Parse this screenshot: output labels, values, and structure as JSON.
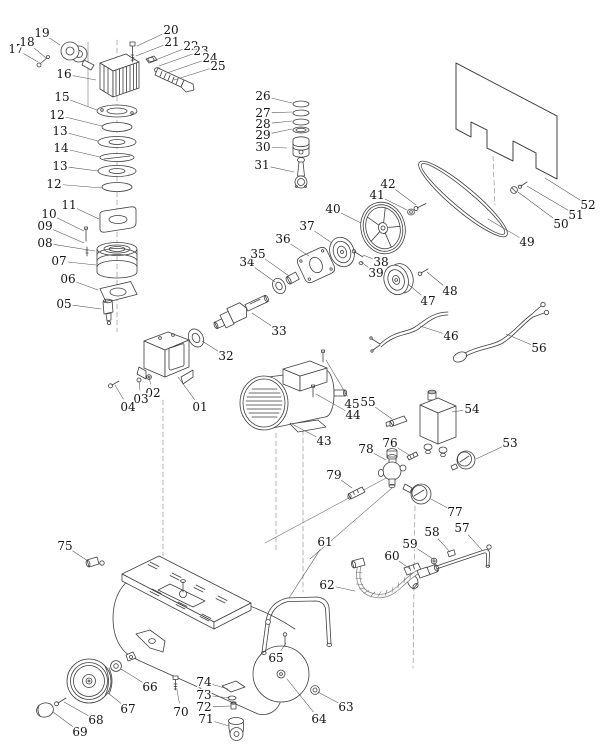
{
  "figure": {
    "kind": "exploded-parts-diagram",
    "subject": "air compressor",
    "background": "#ffffff",
    "line_color": "#3f3f3f",
    "label_color": "#151515"
  },
  "parts": [
    {
      "n": "01",
      "l": [
        200,
        407
      ],
      "t": [
        178,
        377
      ]
    },
    {
      "n": "02",
      "l": [
        153,
        393
      ],
      "t": [
        149,
        378
      ]
    },
    {
      "n": "03",
      "l": [
        141,
        399
      ],
      "t": [
        139,
        381
      ]
    },
    {
      "n": "04",
      "l": [
        128,
        407
      ],
      "t": [
        115,
        385
      ]
    },
    {
      "n": "05",
      "l": [
        64,
        304
      ],
      "t": [
        101,
        309
      ]
    },
    {
      "n": "06",
      "l": [
        68,
        279
      ],
      "t": [
        98,
        290
      ]
    },
    {
      "n": "07",
      "l": [
        59,
        261
      ],
      "t": [
        96,
        265
      ]
    },
    {
      "n": "08",
      "l": [
        45,
        243
      ],
      "t": [
        95,
        251
      ]
    },
    {
      "n": "09",
      "l": [
        45,
        226
      ],
      "t": [
        84,
        243
      ]
    },
    {
      "n": "10",
      "l": [
        49,
        214
      ],
      "t": [
        84,
        231
      ]
    },
    {
      "n": "11",
      "l": [
        69,
        205
      ],
      "t": [
        99,
        219
      ]
    },
    {
      "n": "12",
      "l": [
        54,
        184
      ],
      "t": [
        102,
        188
      ]
    },
    {
      "n": "13",
      "l": [
        60,
        166
      ],
      "t": [
        98,
        171
      ]
    },
    {
      "n": "14",
      "l": [
        61,
        148
      ],
      "t": [
        100,
        157
      ]
    },
    {
      "n": "13",
      "l": [
        60,
        131
      ],
      "t": [
        98,
        141
      ]
    },
    {
      "n": "12",
      "l": [
        57,
        115
      ],
      "t": [
        102,
        126
      ]
    },
    {
      "n": "15",
      "l": [
        62,
        97
      ],
      "t": [
        97,
        110
      ]
    },
    {
      "n": "16",
      "l": [
        64,
        74
      ],
      "t": [
        96,
        80
      ]
    },
    {
      "n": "17",
      "l": [
        16,
        49
      ],
      "t": [
        38,
        62
      ]
    },
    {
      "n": "18",
      "l": [
        27,
        42
      ],
      "t": [
        46,
        58
      ]
    },
    {
      "n": "19",
      "l": [
        42,
        33
      ],
      "t": [
        60,
        45
      ]
    },
    {
      "n": "20",
      "l": [
        171,
        30
      ],
      "t": [
        137,
        46
      ]
    },
    {
      "n": "21",
      "l": [
        172,
        42
      ],
      "t": [
        136,
        56
      ]
    },
    {
      "n": "22",
      "l": [
        191,
        46
      ],
      "t": [
        153,
        61
      ]
    },
    {
      "n": "23",
      "l": [
        201,
        51
      ],
      "t": [
        159,
        66
      ]
    },
    {
      "n": "24",
      "l": [
        210,
        58
      ],
      "t": [
        167,
        73
      ]
    },
    {
      "n": "25",
      "l": [
        218,
        66
      ],
      "t": [
        174,
        80
      ]
    },
    {
      "n": "26",
      "l": [
        263,
        96
      ],
      "t": [
        292,
        103
      ]
    },
    {
      "n": "27",
      "l": [
        263,
        113
      ],
      "t": [
        292,
        112
      ]
    },
    {
      "n": "28",
      "l": [
        263,
        124
      ],
      "t": [
        292,
        121
      ]
    },
    {
      "n": "29",
      "l": [
        263,
        135
      ],
      "t": [
        292,
        129
      ]
    },
    {
      "n": "30",
      "l": [
        263,
        147
      ],
      "t": [
        287,
        148
      ]
    },
    {
      "n": "31",
      "l": [
        262,
        165
      ],
      "t": [
        294,
        172
      ]
    },
    {
      "n": "32",
      "l": [
        226,
        356
      ],
      "t": [
        202,
        341
      ]
    },
    {
      "n": "33",
      "l": [
        279,
        331
      ],
      "t": [
        252,
        313
      ]
    },
    {
      "n": "34",
      "l": [
        247,
        262
      ],
      "t": [
        275,
        282
      ]
    },
    {
      "n": "35",
      "l": [
        258,
        254
      ],
      "t": [
        289,
        276
      ]
    },
    {
      "n": "36",
      "l": [
        283,
        239
      ],
      "t": [
        309,
        256
      ]
    },
    {
      "n": "37",
      "l": [
        307,
        226
      ],
      "t": [
        332,
        243
      ]
    },
    {
      "n": "38",
      "l": [
        381,
        262
      ],
      "t": [
        363,
        255
      ]
    },
    {
      "n": "39",
      "l": [
        376,
        273
      ],
      "t": [
        361,
        262
      ]
    },
    {
      "n": "40",
      "l": [
        333,
        209
      ],
      "t": [
        361,
        223
      ]
    },
    {
      "n": "41",
      "l": [
        377,
        195
      ],
      "t": [
        407,
        210
      ]
    },
    {
      "n": "42",
      "l": [
        388,
        184
      ],
      "t": [
        416,
        205
      ]
    },
    {
      "n": "43",
      "l": [
        324,
        441
      ],
      "t": [
        290,
        423
      ]
    },
    {
      "n": "44",
      "l": [
        353,
        415
      ],
      "t": [
        316,
        394
      ]
    },
    {
      "n": "45",
      "l": [
        352,
        404
      ],
      "t": [
        326,
        360
      ]
    },
    {
      "n": "46",
      "l": [
        451,
        336
      ],
      "t": [
        420,
        326
      ]
    },
    {
      "n": "47",
      "l": [
        428,
        301
      ],
      "t": [
        408,
        284
      ]
    },
    {
      "n": "48",
      "l": [
        450,
        291
      ],
      "t": [
        427,
        272
      ]
    },
    {
      "n": "49",
      "l": [
        527,
        242
      ],
      "t": [
        488,
        219
      ]
    },
    {
      "n": "50",
      "l": [
        561,
        224
      ],
      "t": [
        518,
        192
      ]
    },
    {
      "n": "51",
      "l": [
        576,
        215
      ],
      "t": [
        527,
        186
      ]
    },
    {
      "n": "52",
      "l": [
        588,
        205
      ],
      "t": [
        545,
        178
      ]
    },
    {
      "n": "53",
      "l": [
        510,
        443
      ],
      "t": [
        476,
        459
      ]
    },
    {
      "n": "54",
      "l": [
        472,
        409
      ],
      "t": [
        452,
        412
      ]
    },
    {
      "n": "55",
      "l": [
        368,
        402
      ],
      "t": [
        392,
        419
      ]
    },
    {
      "n": "56",
      "l": [
        539,
        348
      ],
      "t": [
        506,
        334
      ]
    },
    {
      "n": "57",
      "l": [
        462,
        528
      ],
      "t": [
        482,
        550
      ]
    },
    {
      "n": "58",
      "l": [
        432,
        532
      ],
      "t": [
        450,
        552
      ]
    },
    {
      "n": "59",
      "l": [
        410,
        544
      ],
      "t": [
        433,
        559
      ]
    },
    {
      "n": "60",
      "l": [
        392,
        556
      ],
      "t": [
        410,
        569
      ]
    },
    {
      "n": "61",
      "l": [
        325,
        542
      ],
      "t": [
        289,
        598
      ]
    },
    {
      "n": "62",
      "l": [
        327,
        585
      ],
      "t": [
        355,
        591
      ]
    },
    {
      "n": "63",
      "l": [
        346,
        707
      ],
      "t": [
        318,
        692
      ]
    },
    {
      "n": "64",
      "l": [
        319,
        719
      ],
      "t": [
        287,
        679
      ]
    },
    {
      "n": "65",
      "l": [
        276,
        658
      ],
      "t": [
        286,
        643
      ]
    },
    {
      "n": "66",
      "l": [
        150,
        687
      ],
      "t": [
        121,
        669
      ]
    },
    {
      "n": "67",
      "l": [
        128,
        709
      ],
      "t": [
        108,
        693
      ]
    },
    {
      "n": "68",
      "l": [
        96,
        720
      ],
      "t": [
        64,
        702
      ]
    },
    {
      "n": "69",
      "l": [
        80,
        732
      ],
      "t": [
        53,
        712
      ]
    },
    {
      "n": "70",
      "l": [
        181,
        712
      ],
      "t": [
        177,
        690
      ]
    },
    {
      "n": "71",
      "l": [
        206,
        719
      ],
      "t": [
        229,
        726
      ]
    },
    {
      "n": "72",
      "l": [
        204,
        707
      ],
      "t": [
        231,
        706
      ]
    },
    {
      "n": "73",
      "l": [
        204,
        695
      ],
      "t": [
        230,
        698
      ]
    },
    {
      "n": "74",
      "l": [
        204,
        682
      ],
      "t": [
        228,
        689
      ]
    },
    {
      "n": "75",
      "l": [
        65,
        546
      ],
      "t": [
        88,
        561
      ]
    },
    {
      "n": "76",
      "l": [
        390,
        443
      ],
      "t": [
        409,
        455
      ]
    },
    {
      "n": "77",
      "l": [
        455,
        512
      ],
      "t": [
        431,
        499
      ]
    },
    {
      "n": "78",
      "l": [
        366,
        449
      ],
      "t": [
        386,
        460
      ]
    },
    {
      "n": "79",
      "l": [
        334,
        475
      ],
      "t": [
        352,
        488
      ]
    }
  ]
}
